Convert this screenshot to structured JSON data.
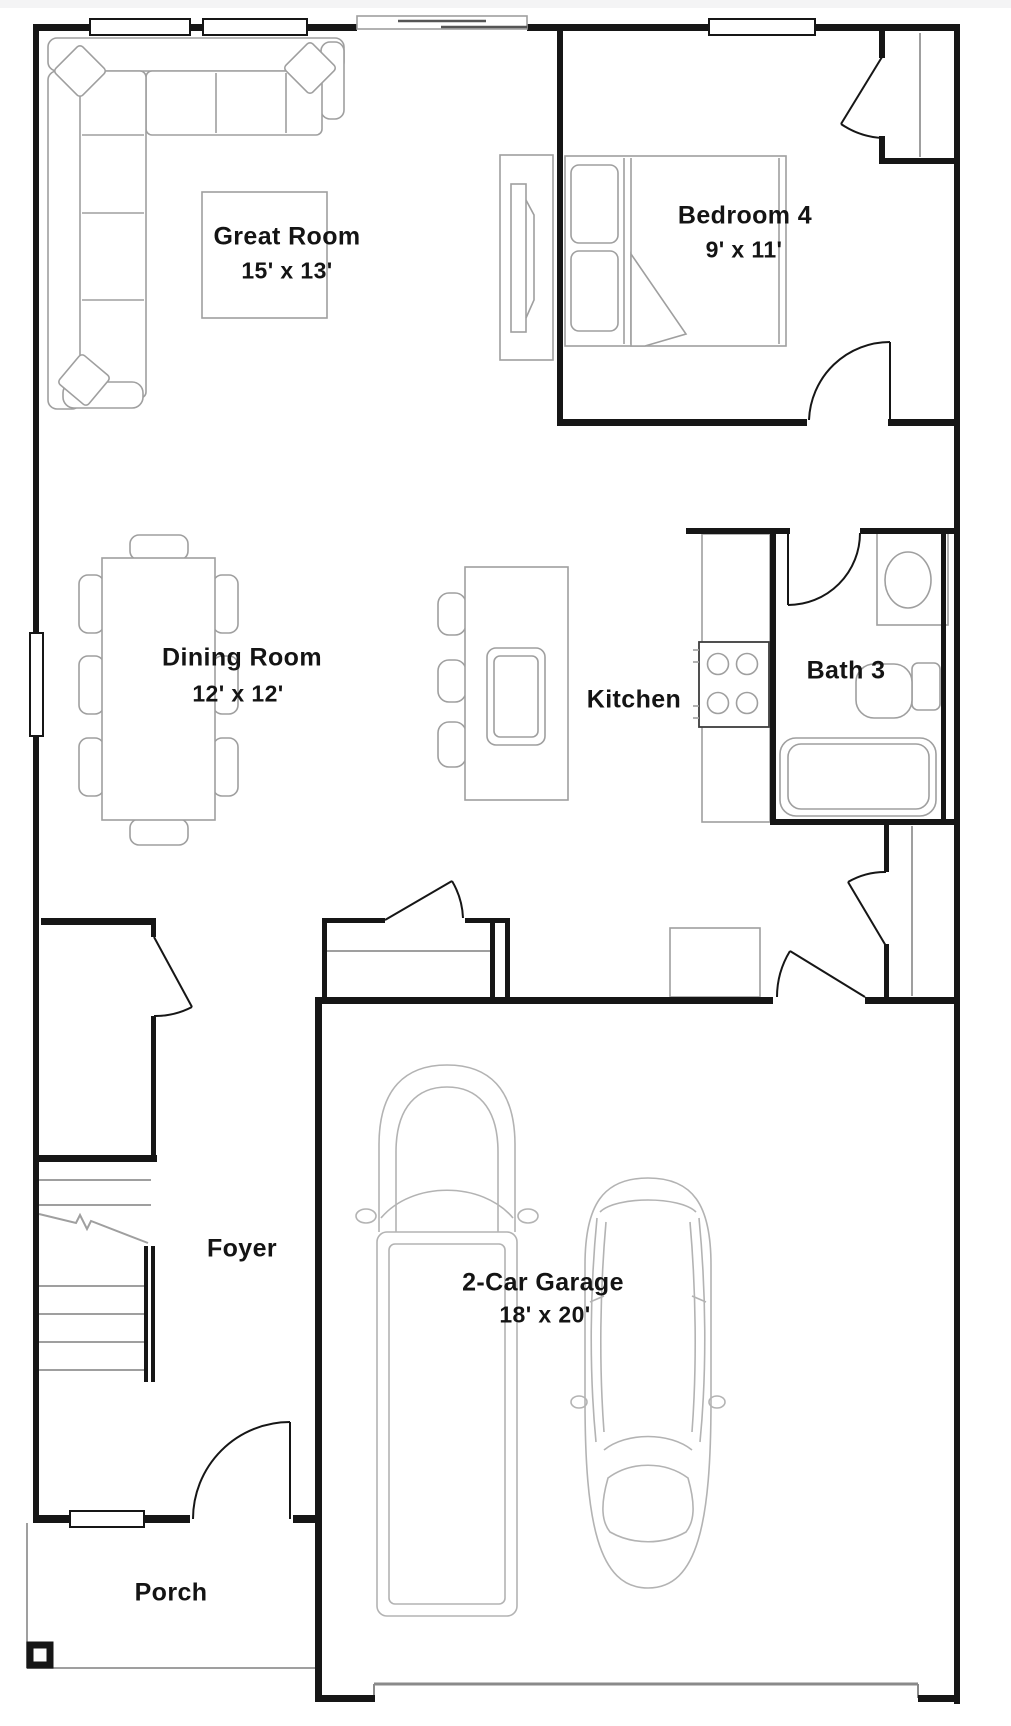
{
  "palette": {
    "wall_color": "#161616",
    "furniture_color": "#9f9f9f",
    "vehicle_color": "#b3b3b3",
    "text_color": "#141414",
    "background": "#ffffff"
  },
  "rooms": {
    "great_room": {
      "name": "Great Room",
      "dims": "15' x 13'"
    },
    "bedroom4": {
      "name": "Bedroom 4",
      "dims": "9' x 11'"
    },
    "dining_room": {
      "name": "Dining Room",
      "dims": "12' x 12'"
    },
    "kitchen": {
      "name": "Kitchen"
    },
    "bath3": {
      "name": "Bath 3"
    },
    "garage": {
      "name": "2-Car Garage",
      "dims": "18' x 20'"
    },
    "foyer": {
      "name": "Foyer"
    },
    "porch": {
      "name": "Porch"
    }
  }
}
